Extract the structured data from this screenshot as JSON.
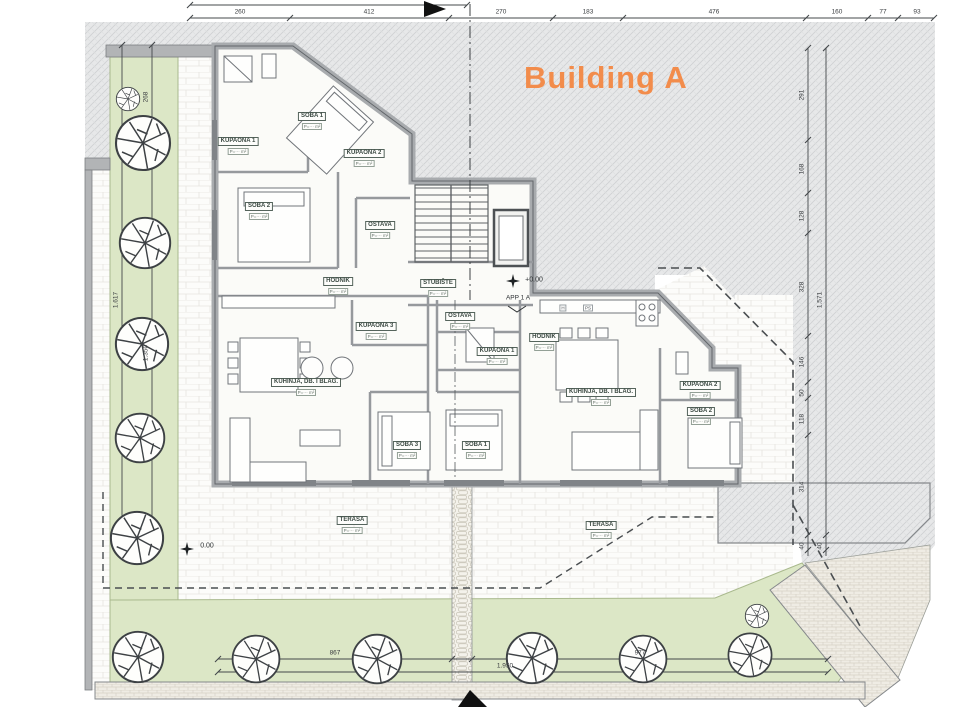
{
  "title": {
    "text": "Building A",
    "color": "#F28C4B"
  },
  "core": {
    "stair_room": {
      "name": "STUBIŠTE",
      "area": "P=··· m²"
    },
    "apartment_ref": "APP 1 A",
    "entry_level": "+0.00",
    "terrace_level": "0.00",
    "closet_h": "H",
    "closet_ps": "PS"
  },
  "apartment_left": {
    "rooms": {
      "kupaona1": {
        "name": "KUPAONA 1",
        "area": "P=··· m²"
      },
      "soba1": {
        "name": "SOBA 1",
        "area": "P=··· m²"
      },
      "kupaona2": {
        "name": "KUPAONA 2",
        "area": "P=··· m²"
      },
      "soba2": {
        "name": "SOBA 2",
        "area": "P=··· m²"
      },
      "ostava": {
        "name": "OSTAVA",
        "area": "P=··· m²"
      },
      "hodnik": {
        "name": "HODNIK",
        "area": "P=··· m²"
      },
      "kupaona3": {
        "name": "KUPAONA 3",
        "area": "P=··· m²"
      },
      "kuhinja": {
        "name": "KUHINJA, DB. I BLAG.",
        "area": "P=··· m²"
      },
      "soba3": {
        "name": "SOBA 3",
        "area": "P=··· m²"
      },
      "terasa": {
        "name": "TERASA",
        "area": "P=··· m²"
      }
    }
  },
  "apartment_right": {
    "rooms": {
      "ostava": {
        "name": "OSTAVA",
        "area": "P=··· m²"
      },
      "kupaona1": {
        "name": "KUPAONA 1",
        "area": "P=··· m²"
      },
      "soba1": {
        "name": "SOBA 1",
        "area": "P=··· m²"
      },
      "hodnik": {
        "name": "HODNIK",
        "area": "P=··· m²"
      },
      "kuhinja": {
        "name": "KUHINJA, DB. I BLAG.",
        "area": "P=··· m²"
      },
      "kupaona2": {
        "name": "KUPAONA 2",
        "area": "P=··· m²"
      },
      "soba2": {
        "name": "SOBA 2",
        "area": "P=··· m²"
      },
      "terasa": {
        "name": "TERASA",
        "area": "P=··· m²"
      }
    }
  },
  "dimensions": {
    "top": [
      "260",
      "412",
      "270",
      "183",
      "476",
      "160",
      "77",
      "93"
    ],
    "bottom_segments": [
      "867",
      "977"
    ],
    "bottom_total": "1.950",
    "left_segments": [
      "268",
      "1.350"
    ],
    "left_total": "1.617",
    "right_segments": [
      "291",
      "168",
      "128",
      "328",
      "146",
      "50",
      "118",
      "314"
    ],
    "right_total": "1.571",
    "right_end": "40"
  }
}
